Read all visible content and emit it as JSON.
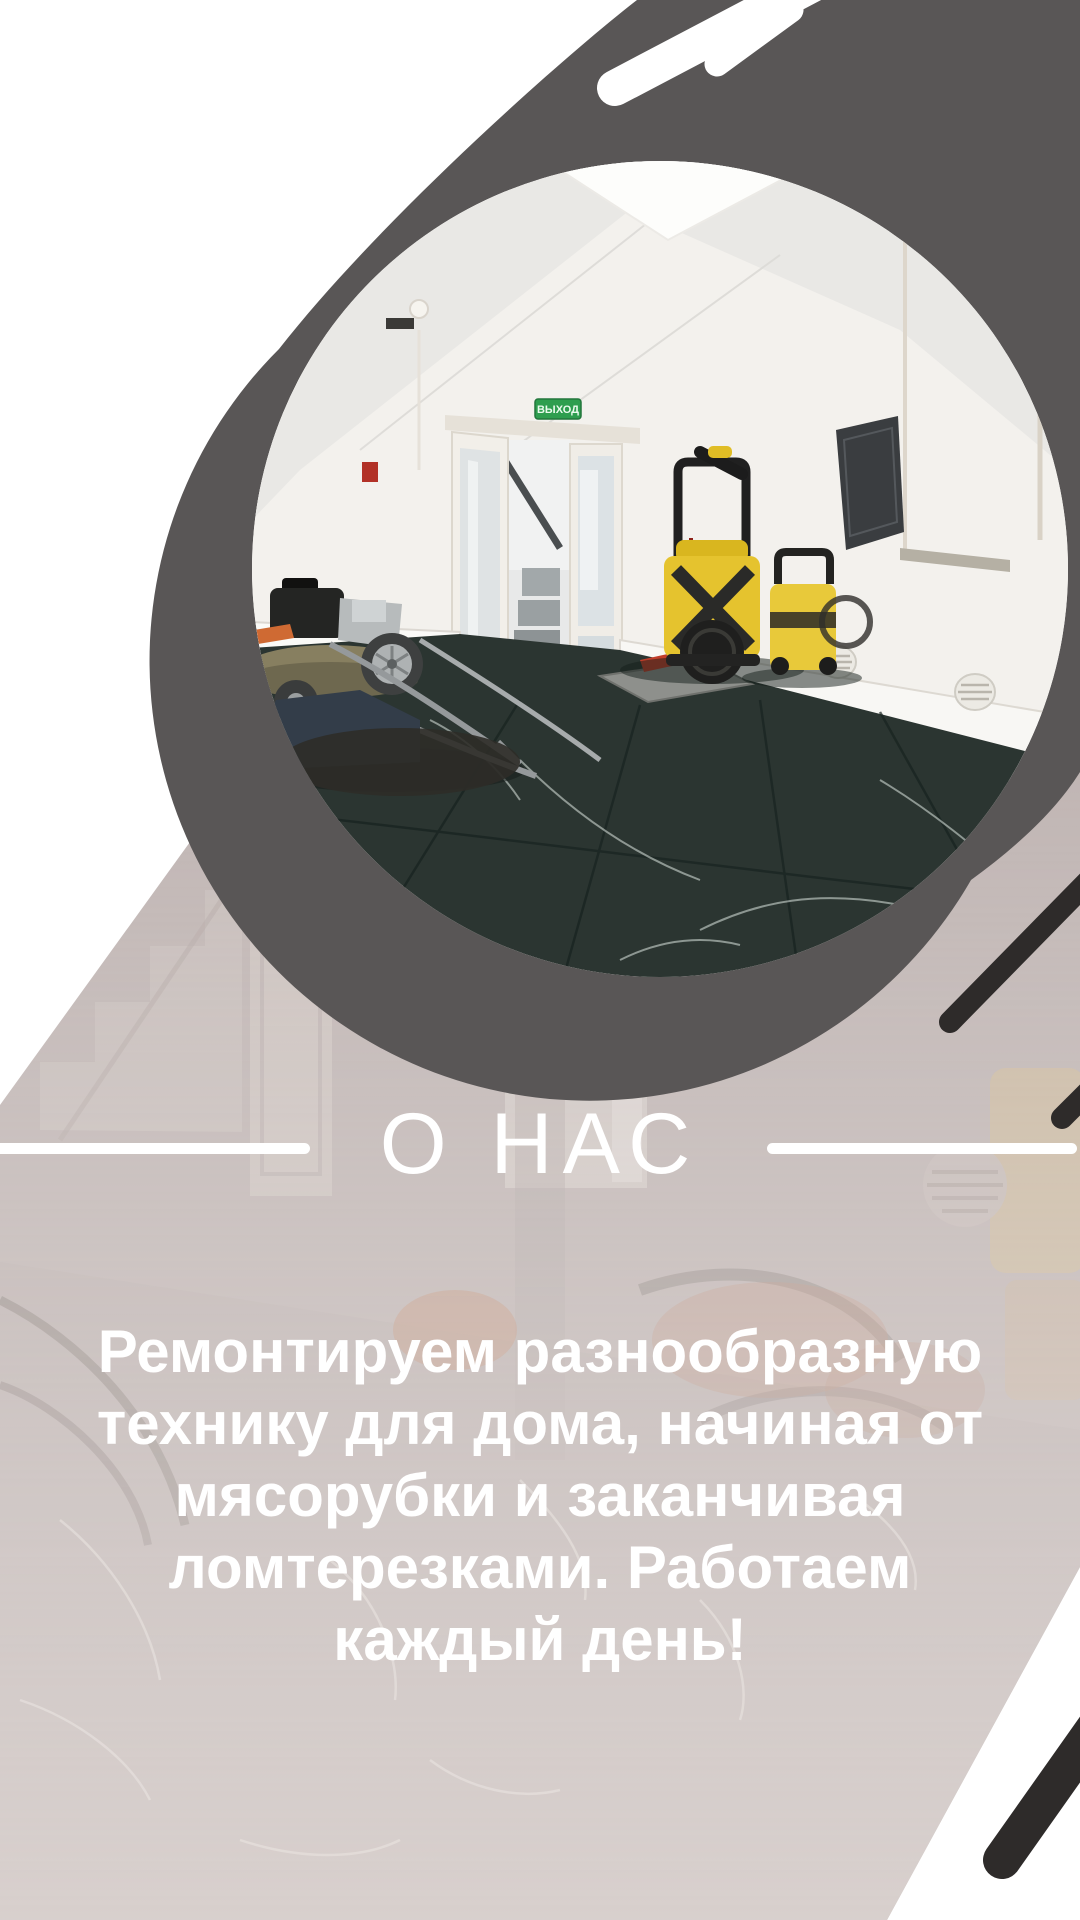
{
  "page": {
    "kind": "social-story-promo",
    "width": 1080,
    "height": 1920
  },
  "colors": {
    "background": "#ffffff",
    "dark_blob": "#595656",
    "near_black_stripe": "#2e2b2a",
    "beige_overlay": "#bfb4b2",
    "text": "#ffffff",
    "exit_sign_green": "#2e9e4f",
    "karcher_yellow": "#e5c32e",
    "floor_marble": "#2b3531"
  },
  "hero": {
    "photo_name": "workshop-interior-circle-photo",
    "exit_sign_text": "ВЫХОД"
  },
  "about": {
    "title": "О НАС",
    "lines": [
      "Ремонтируем разнообразную",
      "технику для дома, начиная от",
      "мясорубки и заканчивая",
      "ломтерезками. Работаем",
      "каждый день!"
    ]
  }
}
